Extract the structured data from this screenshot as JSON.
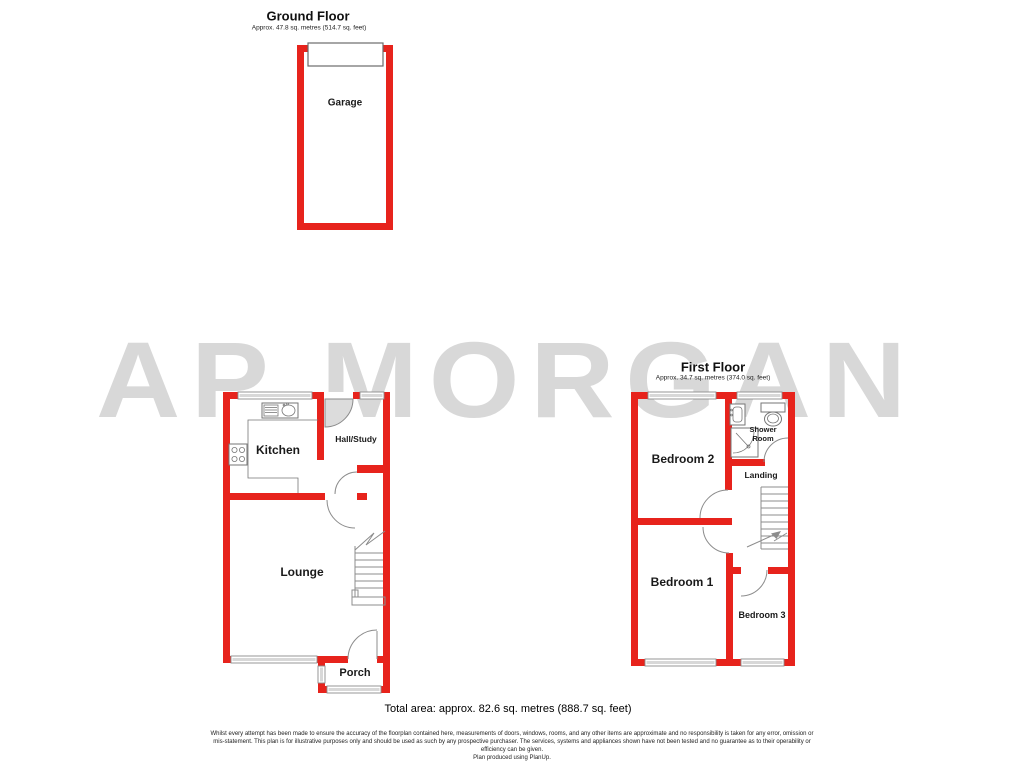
{
  "watermark": {
    "text": "AP MORGAN",
    "color": "#d8d8d8"
  },
  "colors": {
    "wall_red": "#e7231c",
    "line_gray": "#8c8c8c",
    "door_fill": "#dcdcdc",
    "watermark_color": "#d8d8d8"
  },
  "ground_floor": {
    "title": "Ground Floor",
    "subtitle": "Approx. 47.8 sq. metres (514.7 sq. feet)",
    "rooms": {
      "garage": "Garage",
      "kitchen": "Kitchen",
      "hall_study": "Hall/Study",
      "lounge": "Lounge",
      "porch": "Porch"
    }
  },
  "first_floor": {
    "title": "First Floor",
    "subtitle": "Approx. 34.7 sq. metres (374.0 sq. feet)",
    "rooms": {
      "bedroom2": "Bedroom 2",
      "shower_room": "Shower Room",
      "landing": "Landing",
      "bedroom1": "Bedroom 1",
      "bedroom3": "Bedroom 3"
    }
  },
  "footer": {
    "total_area": "Total area: approx. 82.6 sq. metres (888.7 sq. feet)",
    "disclaimer_line1": "Whilst every attempt has been made to ensure the accuracy of the floorplan contained here, measurements of doors, windows, rooms, and any other items are approximate and no responsibility is taken for any error, omission or",
    "disclaimer_line2": "mis-statement. This plan is for illustrative purposes only and should be used as such by any prospective purchaser. The services, systems and appliances shown have not been tested and no guarantee as to their operability or",
    "disclaimer_line3": "efficiency can be given.",
    "credit": "Plan produced using PlanUp."
  }
}
